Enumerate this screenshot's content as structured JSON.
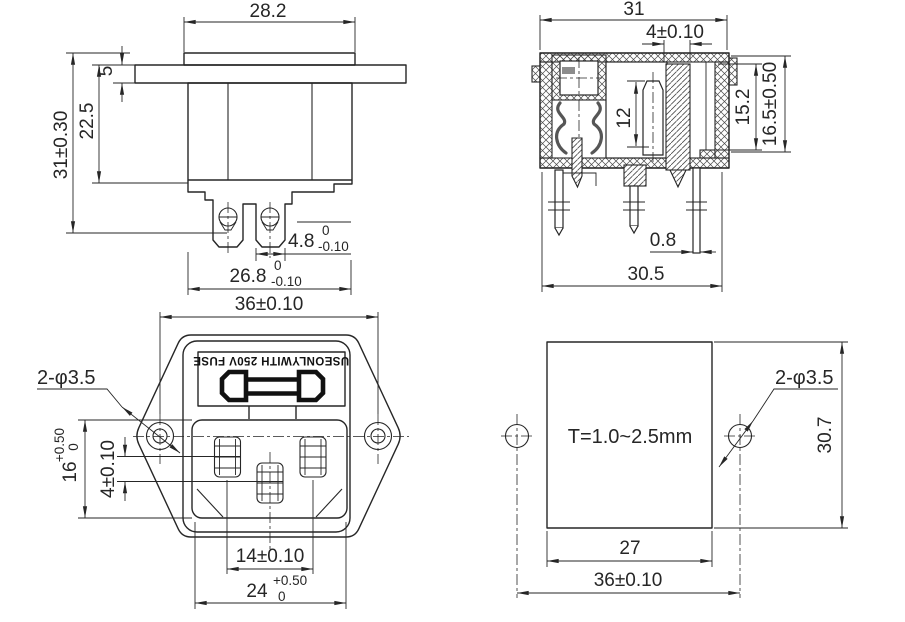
{
  "drawing": {
    "background": "#ffffff",
    "line_color": "#262626",
    "type": "technical-dimension-drawing"
  },
  "views": {
    "side_view": {
      "dims": {
        "rim_width": "28.2",
        "flange_thickness": "5",
        "body_depth": "22.5",
        "overall_depth": "31±0.30",
        "terminal_width": "4.8",
        "terminal_width_tol_top": "0",
        "terminal_width_tol_bottom": "-0.10",
        "body_width": "26.8",
        "body_width_tol_top": "0",
        "body_width_tol_bottom": "-0.10"
      }
    },
    "section_view": {
      "dims": {
        "overall_width": "31",
        "pin_width": "4±0.10",
        "contact_height": "12",
        "inner_depth": "15.2",
        "overall_depth": "16.5±0.50",
        "pin_thickness": "0.8",
        "base_width": "30.5"
      }
    },
    "front_view": {
      "marking": "USEONLYWITH 250V FUSE",
      "dims": {
        "mounting_hole_pitch": "36±0.10",
        "mounting_holes": "2-φ3.5",
        "opening_height": "16",
        "opening_height_tol_top": "+0.50",
        "opening_height_tol_bottom": "0",
        "pin_row_offset": "4±0.10",
        "pin_pitch": "14±0.10",
        "opening_width": "24",
        "opening_width_tol_top": "+0.50",
        "opening_width_tol_bottom": "0"
      }
    },
    "cutout_view": {
      "panel_thickness_note": "T=1.0~2.5mm",
      "dims": {
        "mounting_holes": "2-φ3.5",
        "cutout_height": "30.7",
        "cutout_width": "27",
        "mounting_hole_pitch": "36±0.10"
      }
    }
  }
}
